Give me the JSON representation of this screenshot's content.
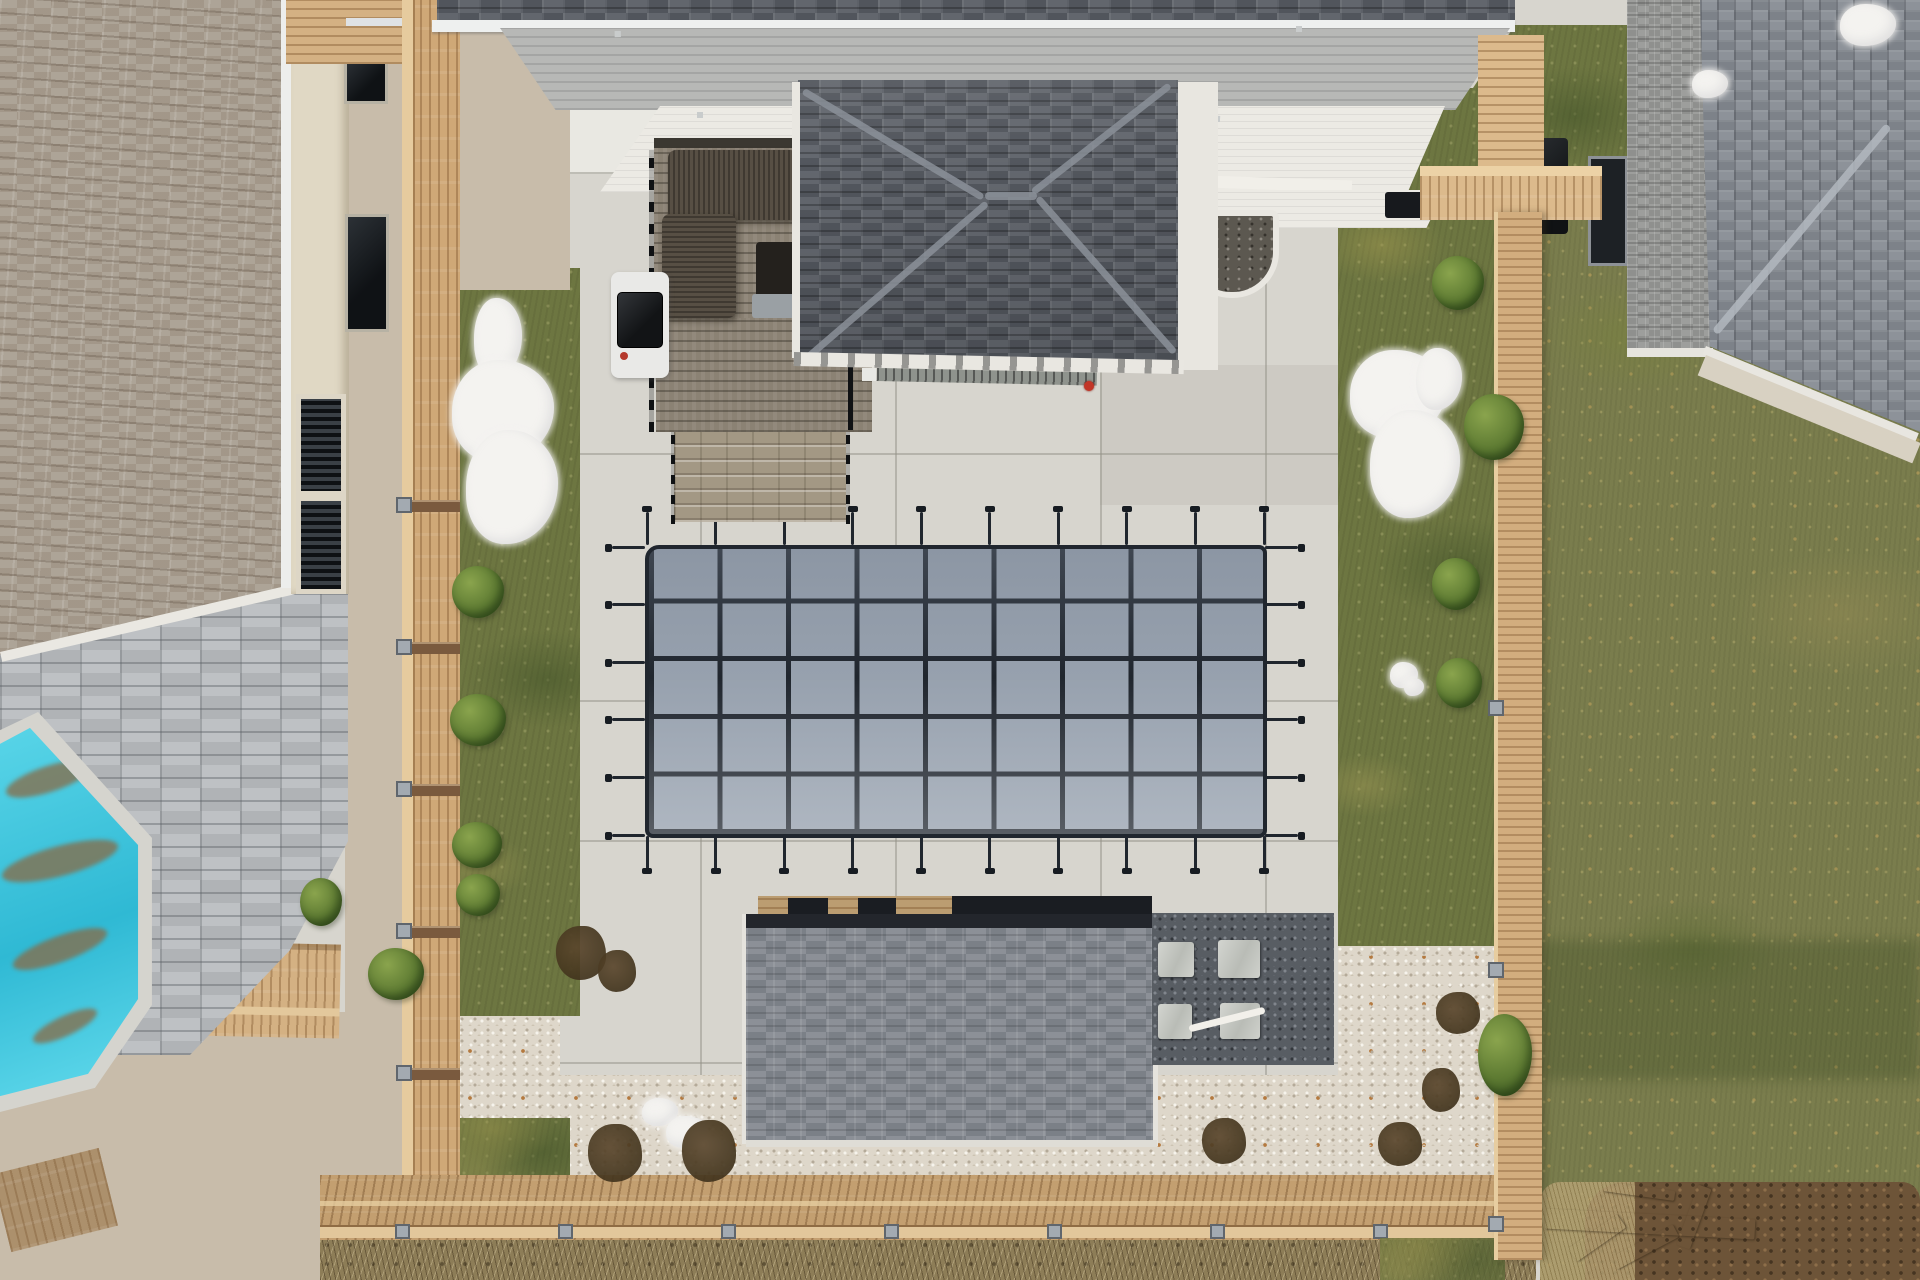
{
  "image": {
    "type": "aerial-drone-photo",
    "subject": "backyard with winter-covered rectangular pool, concrete patio, wooden fences, neighboring houses",
    "width": 1920,
    "height": 1280
  },
  "palette": {
    "concrete": "#d7d5ce",
    "concrete_light": "#e9e8e2",
    "pool_cover": "#97a1ae",
    "strap": "#20262e",
    "grass": "#6d7641",
    "lawn": "#7a7d4d",
    "fence": "#d4b183",
    "fence_dark": "#a9855a",
    "roof_dark": "#585c64",
    "roof_mid": "#83888f",
    "roof_tan": "#a89e91",
    "pavers": "#b7babd",
    "pool_teal": "#3ec7de",
    "gravel_white": "#ded7ca",
    "gravel_dark": "#585d63",
    "gravel_tan": "#c8bcaa",
    "snow": "#f4f3f0",
    "wood_deck": "#8b8274",
    "cream": "#e0d8c4",
    "white": "#eceae4",
    "soil": "#6d5438",
    "accent_red": "#c23527",
    "teal_debris": "#8a6a45"
  },
  "pool_cover": {
    "x": 645,
    "y": 545,
    "w": 622,
    "h": 293,
    "cols": 9,
    "rows": 5,
    "stub": 33,
    "head": 7
  },
  "left_fence_posts_y": [
    500,
    642,
    784,
    926,
    1068
  ],
  "right_fence_caps_y": [
    428,
    700,
    962,
    1216
  ],
  "bottom_fence_caps_x": [
    395,
    558,
    721,
    884,
    1047,
    1210,
    1373
  ],
  "skylight_pairs": [
    [
      615,
      30,
      128,
      36,
      -1
    ],
    [
      1296,
      26,
      132,
      30,
      0
    ]
  ],
  "wall_window_pairs": [
    [
      697,
      112,
      98,
      42,
      0
    ],
    [
      1213,
      118,
      130,
      62,
      2
    ]
  ],
  "left_house_windows": [
    [
      332,
      0,
      52,
      30
    ],
    [
      344,
      58,
      44,
      46
    ],
    [
      345,
      214,
      44,
      118
    ]
  ],
  "bay_window": [
    296,
    394,
    50,
    200
  ],
  "stepping_pavers": [
    [
      1158,
      942,
      36,
      35
    ],
    [
      1218,
      940,
      42,
      38
    ],
    [
      1158,
      1004,
      34,
      35
    ],
    [
      1220,
      1003,
      40,
      36
    ]
  ],
  "shrubs": [
    [
      452,
      566,
      52,
      52
    ],
    [
      450,
      694,
      56,
      52
    ],
    [
      452,
      822,
      50,
      46
    ],
    [
      456,
      874,
      44,
      42
    ],
    [
      368,
      948,
      56,
      52
    ],
    [
      300,
      878,
      42,
      48
    ],
    [
      1432,
      256,
      52,
      54
    ],
    [
      1464,
      394,
      60,
      66
    ],
    [
      1432,
      558,
      48,
      52
    ],
    [
      1436,
      658,
      46,
      50
    ],
    [
      1478,
      1014,
      54,
      82
    ]
  ],
  "snow_patches": [
    [
      474,
      298,
      48,
      80
    ],
    [
      452,
      360,
      102,
      102
    ],
    [
      466,
      430,
      92,
      114
    ],
    [
      1350,
      350,
      96,
      88
    ],
    [
      1370,
      410,
      90,
      108
    ],
    [
      1416,
      348,
      46,
      62
    ],
    [
      1390,
      662,
      28,
      26
    ],
    [
      1404,
      678,
      20,
      18
    ],
    [
      642,
      1098,
      36,
      28
    ],
    [
      666,
      1116,
      42,
      32
    ],
    [
      698,
      1138,
      32,
      24
    ],
    [
      1840,
      4,
      56,
      42
    ],
    [
      1692,
      70,
      36,
      28
    ]
  ],
  "debris_patches": [
    [
      588,
      1124,
      54,
      58
    ],
    [
      682,
      1120,
      54,
      62
    ],
    [
      1202,
      1118,
      44,
      46
    ],
    [
      1378,
      1122,
      44,
      44
    ],
    [
      1436,
      992,
      44,
      42
    ],
    [
      1422,
      1068,
      38,
      44
    ],
    [
      556,
      926,
      50,
      54
    ],
    [
      598,
      950,
      38,
      42
    ]
  ],
  "lawn_boards": [
    [
      1567,
      1230,
      60,
      16,
      -35
    ],
    [
      1610,
      1240,
      70,
      14,
      -28
    ],
    [
      1662,
      1210,
      64,
      14,
      -70
    ],
    [
      1603,
      1186,
      72,
      10,
      8
    ],
    [
      1545,
      1214,
      210,
      20,
      3
    ]
  ],
  "cabana_gaps": [
    [
      788,
      898,
      40,
      20
    ],
    [
      858,
      898,
      38,
      20
    ],
    [
      952,
      896,
      200,
      18
    ]
  ],
  "pool_debris": [
    [
      4,
      40,
      90,
      26,
      -18
    ],
    [
      0,
      120,
      120,
      30,
      -15
    ],
    [
      10,
      210,
      100,
      26,
      -20
    ],
    [
      30,
      290,
      70,
      20,
      -25
    ]
  ]
}
